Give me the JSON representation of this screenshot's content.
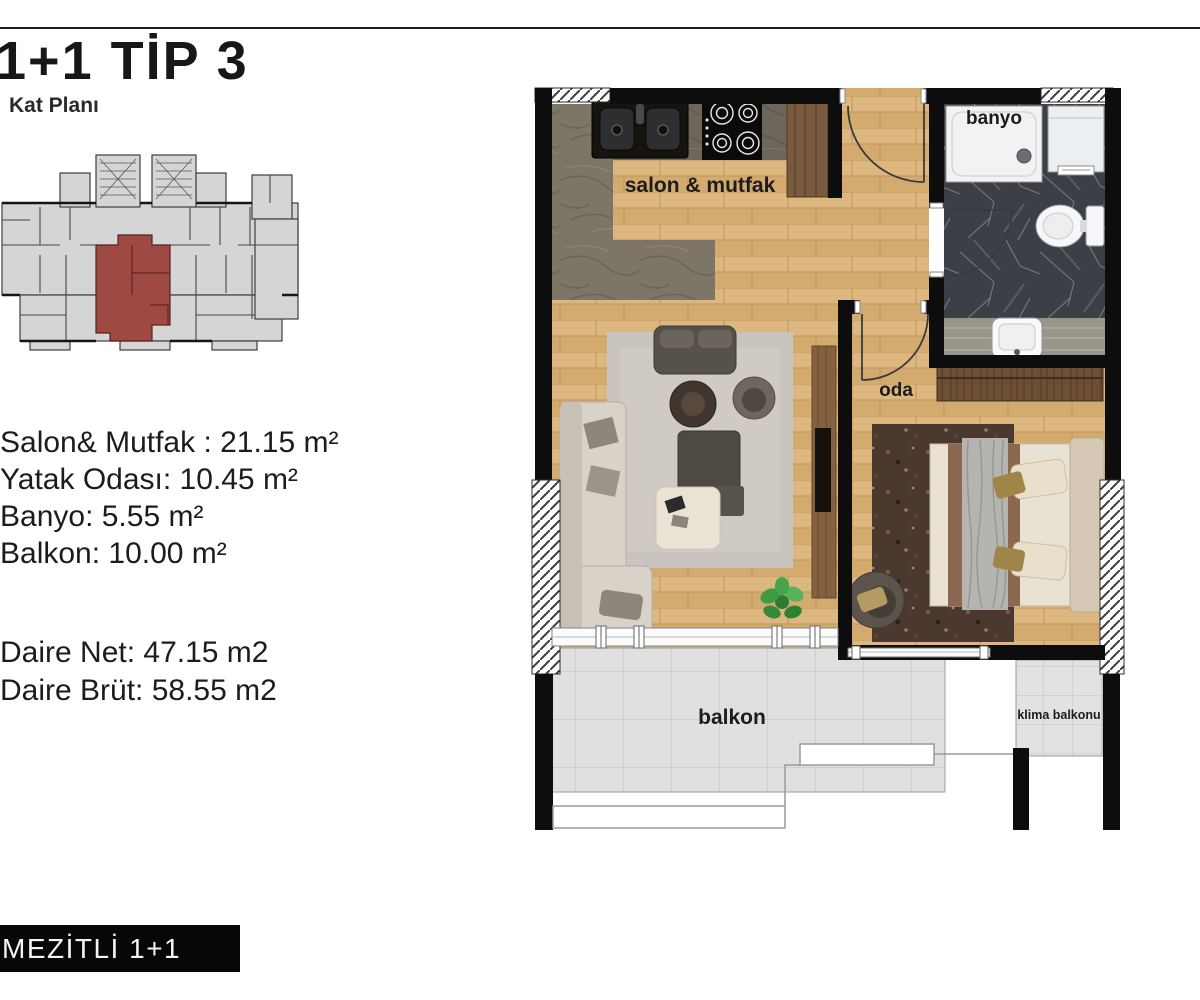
{
  "page": {
    "title": "1+1 TİP 3",
    "subtitle": "Kat Planı",
    "banner": "MEZİTLİ 1+1"
  },
  "areas": {
    "lines": [
      "Salon& Mutfak : 21.15 m²",
      "Yatak Odası: 10.45 m²",
      "Banyo: 5.55 m²",
      "Balkon: 10.00 m²"
    ],
    "totals": [
      "Daire Net: 47.15 m2",
      "Daire Brüt: 58.55 m2"
    ]
  },
  "plan": {
    "type": "1+1",
    "net_m2": 47.15,
    "brut_m2": 58.55,
    "rooms": [
      {
        "name": "salon-mutfak",
        "label": "salon & mutfak",
        "area_m2": 21.15
      },
      {
        "name": "yatak-odasi",
        "label": "oda",
        "area_m2": 10.45
      },
      {
        "name": "banyo",
        "label": "banyo",
        "area_m2": 5.55
      },
      {
        "name": "balkon",
        "label": "balkon",
        "area_m2": 10.0
      },
      {
        "name": "klima-balkonu",
        "label": "klima balkonu",
        "area_m2": null
      }
    ]
  },
  "colors": {
    "highlight_red": "#9e4a43",
    "wood_floor": "#d9b47c",
    "kitchen_gray": "#7c7568",
    "bath_marble": "#3c4046",
    "balcony_tile": "#e0e0e0",
    "wall_black": "#0d0d0d"
  }
}
